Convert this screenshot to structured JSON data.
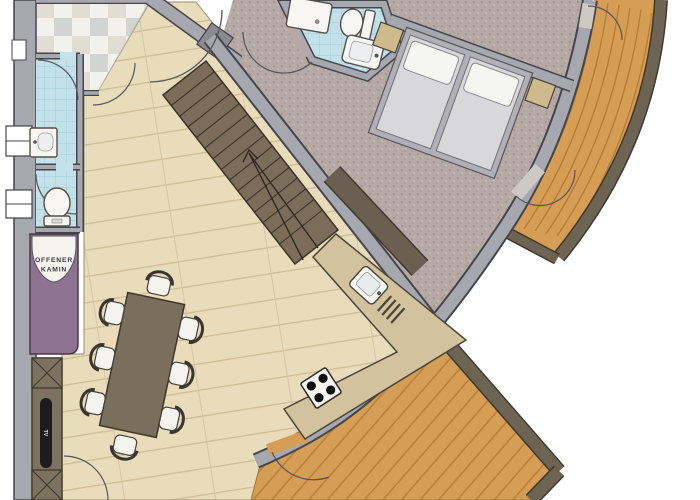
{
  "labels": {
    "fireplace_line1": "OFFENER",
    "fireplace_line2": "KAMIN",
    "tv": "TV"
  },
  "colors": {
    "wood_floor": "#e9dcbb",
    "wood_plank_line": "#cdbc94",
    "carpet": "#b4a9a5",
    "tile_blue": "#c3e1e9",
    "tile_blue_line": "#96c8d6",
    "entry_tile": "#f2efe9",
    "deck_wood": "#d69d55",
    "deck_plank_line": "#b67d38",
    "deck_border": "#6d6454",
    "wall_gray": "#a7a7af",
    "wall_outline": "#45454c",
    "stairs": "#7b6d59",
    "fireplace_purple": "#8d7291",
    "counter_beige": "#d3c29e",
    "table_brown": "#7a6e5c",
    "tv_black": "#1c1c1e",
    "bed_platform": "#b0b0b6",
    "nightstand_tan": "#cdbb8e",
    "fixture_white": "#f7f6f3"
  }
}
